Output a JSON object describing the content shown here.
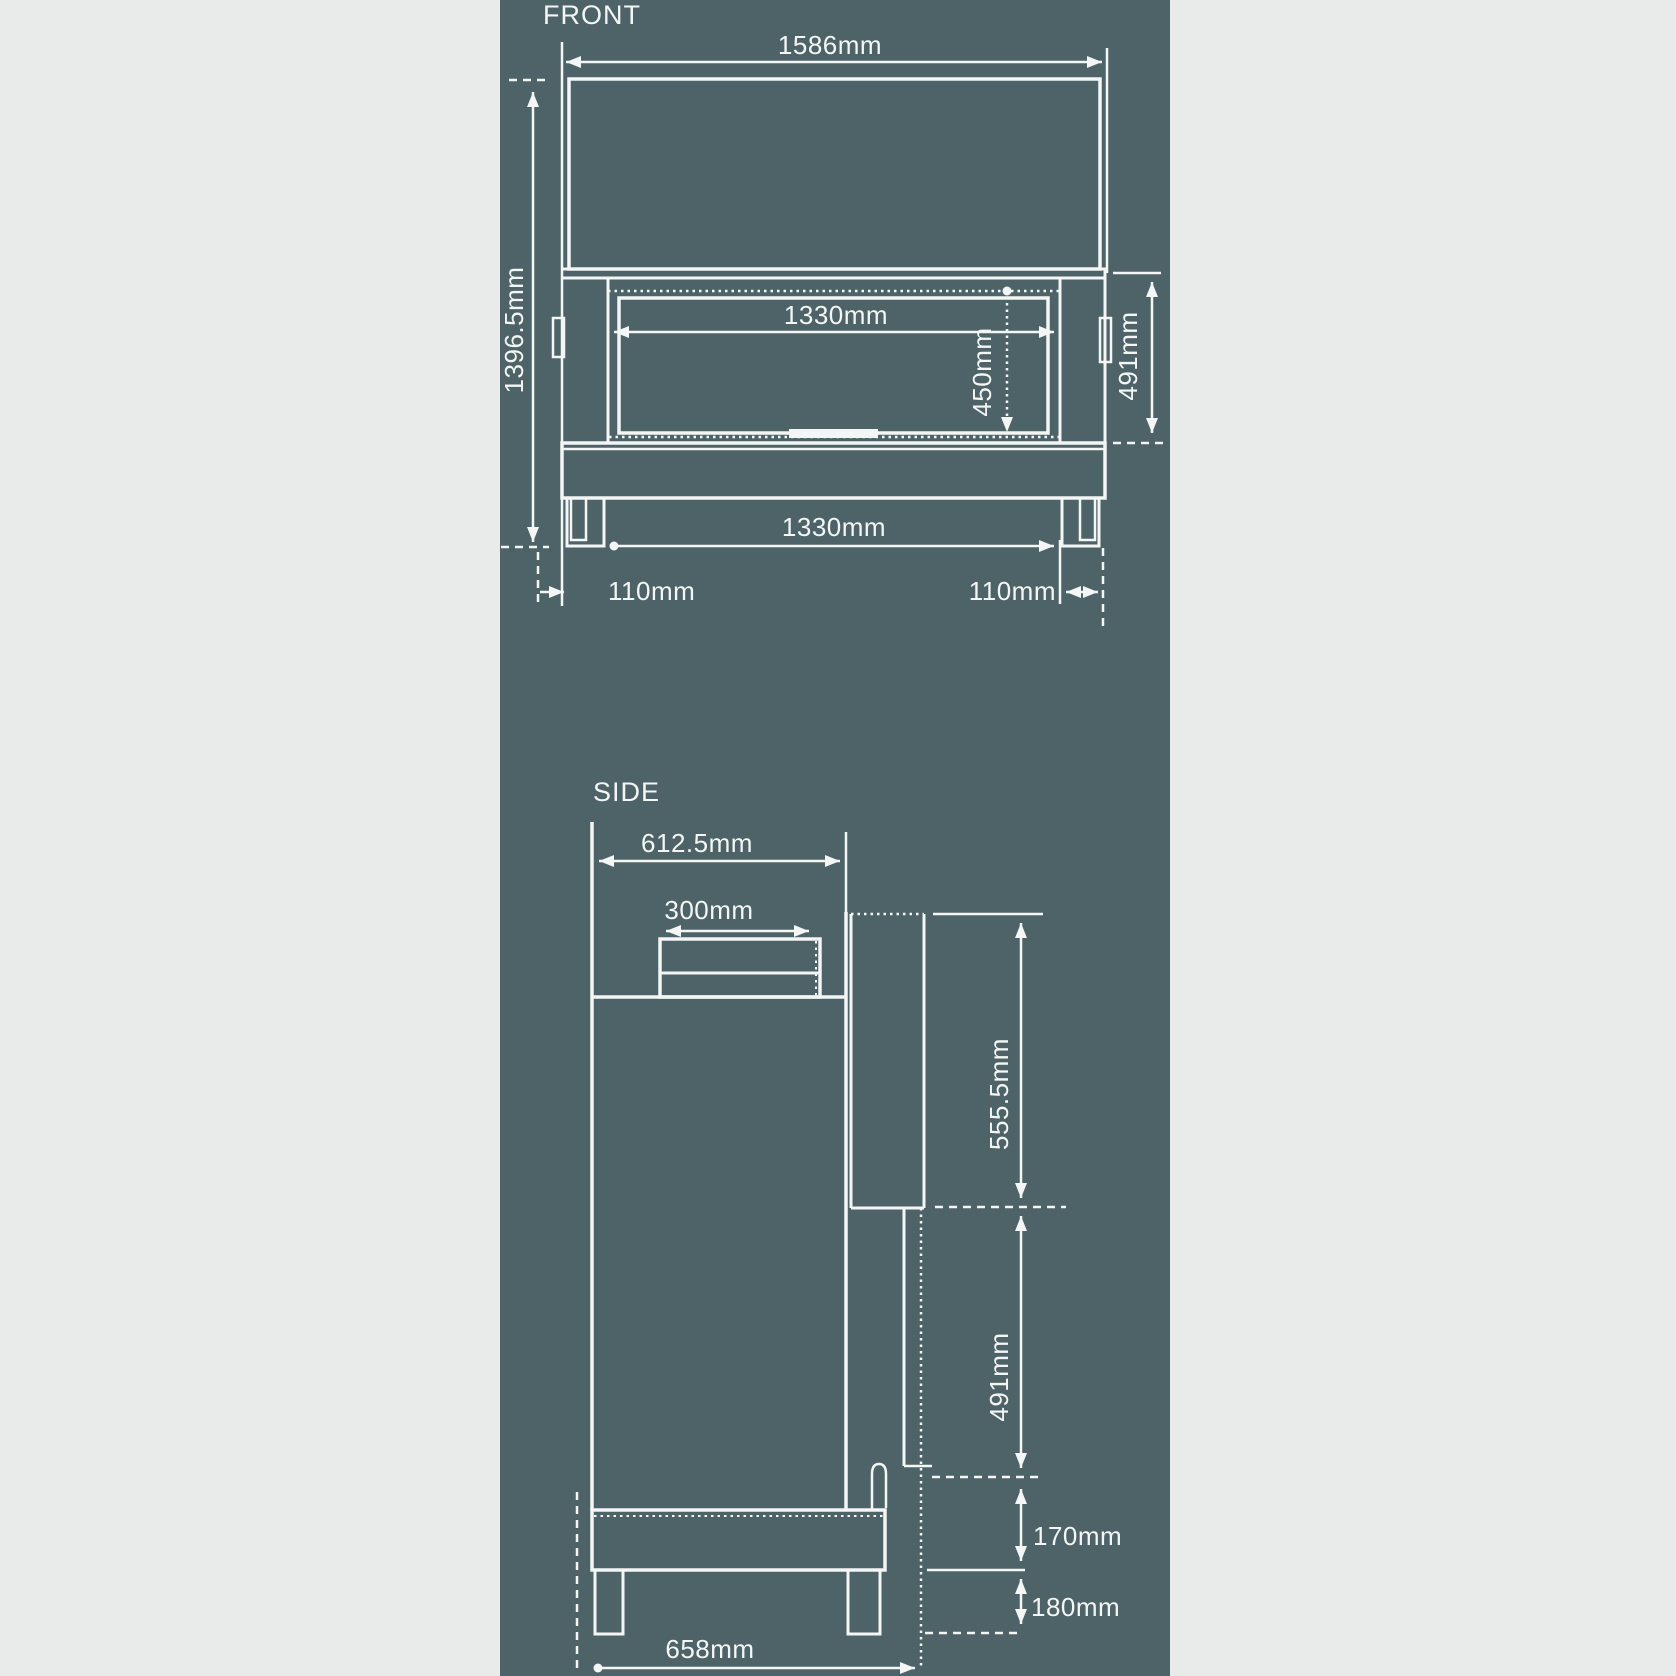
{
  "colors": {
    "margin_background": "#e9eaea",
    "panel_background": "#4d6367",
    "line_and_text": "#f3f6f5"
  },
  "front_view": {
    "label": "FRONT",
    "overall_width": "1586mm",
    "overall_height": "1396.5mm",
    "opening_width": "1330mm",
    "opening_height": "450mm",
    "firebox_height": "491mm",
    "base_inner_width": "1330mm",
    "left_leg_width": "110mm",
    "right_leg_width": "110mm"
  },
  "side_view": {
    "label": "SIDE",
    "top_depth": "612.5mm",
    "flue_depth": "300mm",
    "rear_duct_height": "555.5mm",
    "firebox_height": "491mm",
    "hearth_height": "170mm",
    "base_height": "180mm",
    "overall_depth": "658mm"
  }
}
